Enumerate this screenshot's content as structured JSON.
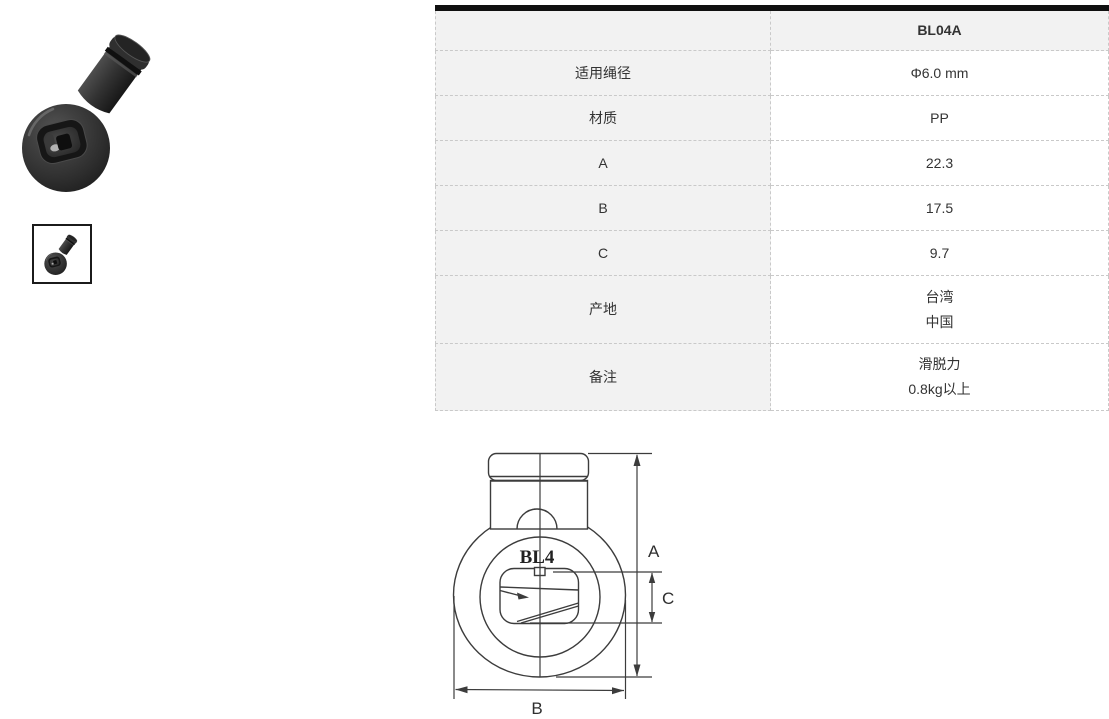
{
  "table": {
    "header_model": "BL04A",
    "rows": [
      {
        "label": "适用绳径",
        "lines": [
          "Φ6.0 mm"
        ]
      },
      {
        "label": "材质",
        "lines": [
          "PP"
        ]
      },
      {
        "label": "A",
        "lines": [
          "22.3"
        ]
      },
      {
        "label": "B",
        "lines": [
          "17.5"
        ]
      },
      {
        "label": "C",
        "lines": [
          "9.7"
        ]
      },
      {
        "label": "产地",
        "lines": [
          "台湾",
          "中国"
        ]
      },
      {
        "label": "备注",
        "lines": [
          "滑脱力",
          "0.8kg以上"
        ]
      }
    ]
  },
  "drawing": {
    "model_label": "BL4",
    "dim_a": "A",
    "dim_b": "B",
    "dim_c": "C"
  },
  "colors": {
    "table_top_bar": "#101010",
    "label_column_bg": "#f2f2f2",
    "dashed_border": "#c9c9c9",
    "text": "#333333",
    "drawing_line": "#3c3c3c",
    "product_body": "#333333"
  }
}
